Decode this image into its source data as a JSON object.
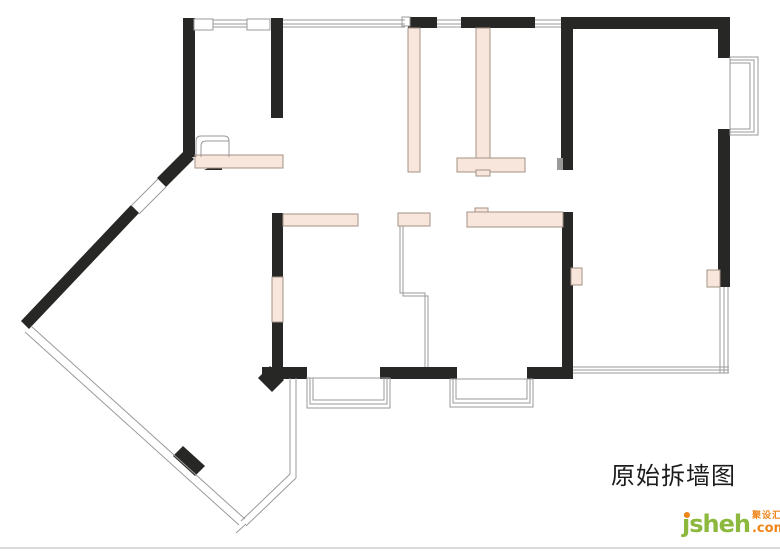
{
  "title": {
    "text": "原始拆墙图"
  },
  "logo": {
    "brand": "jsheh",
    "tagline": "聚设汇",
    "suffix": ".com"
  },
  "colors": {
    "wall": "#272725",
    "demo_fill": "#f8e6dc",
    "demo_stroke": "#a49286",
    "line": "#9a9a9a",
    "title_color": "#1c1c1c",
    "brand_green": "#8cb83d",
    "accent_orange": "#f08519",
    "divider": "#d9d9d9"
  },
  "plan": {
    "width": 780,
    "height": 551,
    "elements": [
      {
        "type": "wall",
        "name": "wall-left-top-vertical",
        "x": 183,
        "y": 18,
        "w": 12,
        "h": 139
      },
      {
        "type": "wall",
        "name": "wall-entry-vertical",
        "x": 271,
        "y": 18,
        "w": 12,
        "h": 100
      },
      {
        "type": "wall",
        "name": "wall-top-a",
        "x": 408,
        "y": 17,
        "w": 29,
        "h": 11
      },
      {
        "type": "wall",
        "name": "wall-top-b",
        "x": 461,
        "y": 17,
        "w": 74,
        "h": 11
      },
      {
        "type": "wall",
        "name": "wall-top-right",
        "x": 561,
        "y": 17,
        "w": 169,
        "h": 12
      },
      {
        "type": "wall",
        "name": "wall-livingroom-left-upper",
        "x": 561,
        "y": 17,
        "w": 12,
        "h": 153
      },
      {
        "type": "wall",
        "name": "wall-right-upper",
        "x": 718,
        "y": 17,
        "w": 12,
        "h": 41
      },
      {
        "type": "wall",
        "name": "wall-right-lower",
        "x": 718,
        "y": 129,
        "w": 12,
        "h": 158
      },
      {
        "type": "wall",
        "name": "wall-livingroom-left-lower",
        "x": 562,
        "y": 212,
        "w": 11,
        "h": 155
      },
      {
        "type": "wall",
        "name": "wall-interior-left-upper",
        "x": 272,
        "y": 213,
        "w": 11,
        "h": 64
      },
      {
        "type": "wall",
        "name": "wall-interior-left-lower",
        "x": 272,
        "y": 322,
        "w": 11,
        "h": 46
      },
      {
        "type": "wall",
        "name": "wall-bottom-left",
        "x": 262,
        "y": 367,
        "w": 45,
        "h": 12
      },
      {
        "type": "wall",
        "name": "wall-bottom-middle",
        "x": 380,
        "y": 367,
        "w": 77,
        "h": 12
      },
      {
        "type": "wall",
        "name": "wall-bottom-right",
        "x": 527,
        "y": 367,
        "w": 46,
        "h": 12
      },
      {
        "type": "wall",
        "name": "wall-diagonal-upper",
        "points": "185,150 194,159 166,187 157,178"
      },
      {
        "type": "wall",
        "name": "wall-diagonal-lower",
        "points": "131,205 139,213 29,329 21,321"
      },
      {
        "type": "wall",
        "name": "wall-diagonal-chunk",
        "points": "173,456 183,446 205,466 195,476"
      },
      {
        "type": "wall",
        "name": "wall-corner-stub",
        "points": "258,378 270,366 284,380 272,392"
      },
      {
        "type": "wall",
        "name": "door-threshold-triangle",
        "points": "204,170 222,162 222,170"
      },
      {
        "type": "demo",
        "name": "demolish-wall-entry",
        "x": 195,
        "y": 155,
        "w": 88,
        "h": 13
      },
      {
        "type": "demo",
        "name": "demolish-wall-kitchen-left",
        "x": 408,
        "y": 28,
        "w": 12,
        "h": 144
      },
      {
        "type": "demo",
        "name": "demolish-wall-kitchen-right",
        "x": 476,
        "y": 28,
        "w": 14,
        "h": 130
      },
      {
        "type": "demo",
        "name": "demolish-wall-kitchen-tbar",
        "x": 457,
        "y": 158,
        "w": 68,
        "h": 14
      },
      {
        "type": "demo",
        "name": "demolish-wall-kitchen-notch",
        "x": 476,
        "y": 170,
        "w": 14,
        "h": 6
      },
      {
        "type": "demo",
        "name": "demolish-wall-bedroom-a",
        "x": 283,
        "y": 214,
        "w": 75,
        "h": 12
      },
      {
        "type": "demo",
        "name": "demolish-wall-bedroom-b",
        "x": 398,
        "y": 213,
        "w": 32,
        "h": 13
      },
      {
        "type": "demo",
        "name": "demolish-wall-hall-bump",
        "x": 475,
        "y": 208,
        "w": 13,
        "h": 5
      },
      {
        "type": "demo",
        "name": "demolish-wall-hall",
        "x": 467,
        "y": 212,
        "w": 96,
        "h": 15
      },
      {
        "type": "demo",
        "name": "demolish-wall-interior-left",
        "x": 272,
        "y": 277,
        "w": 11,
        "h": 45
      },
      {
        "type": "demo",
        "name": "demolish-balcony-left",
        "x": 571,
        "y": 268,
        "w": 11,
        "h": 17
      },
      {
        "type": "demo",
        "name": "demolish-balcony-right",
        "x": 707,
        "y": 270,
        "w": 13,
        "h": 17
      },
      {
        "type": "winbox",
        "name": "window-box-a",
        "x": 194,
        "y": 19,
        "w": 19,
        "h": 11
      },
      {
        "type": "winbox",
        "name": "window-box-b",
        "x": 247,
        "y": 19,
        "w": 23,
        "h": 11
      },
      {
        "type": "winbox",
        "name": "window-box-c",
        "x": 402,
        "y": 17,
        "w": 8,
        "h": 9
      },
      {
        "type": "line",
        "name": "window-line",
        "x1": 213,
        "y1": 20,
        "x2": 247,
        "y2": 20
      },
      {
        "type": "line",
        "name": "window-line",
        "x1": 213,
        "y1": 24,
        "x2": 247,
        "y2": 24
      },
      {
        "type": "line",
        "name": "window-line",
        "x1": 213,
        "y1": 27,
        "x2": 247,
        "y2": 27
      },
      {
        "type": "line",
        "name": "window-line",
        "x1": 283,
        "y1": 20,
        "x2": 405,
        "y2": 20
      },
      {
        "type": "line",
        "name": "window-line",
        "x1": 283,
        "y1": 24,
        "x2": 405,
        "y2": 24
      },
      {
        "type": "line",
        "name": "window-line",
        "x1": 283,
        "y1": 27,
        "x2": 405,
        "y2": 27
      },
      {
        "type": "line",
        "name": "window-line",
        "x1": 437,
        "y1": 20,
        "x2": 461,
        "y2": 20
      },
      {
        "type": "line",
        "name": "window-line",
        "x1": 437,
        "y1": 24,
        "x2": 461,
        "y2": 24
      },
      {
        "type": "line",
        "name": "window-line",
        "x1": 437,
        "y1": 27,
        "x2": 461,
        "y2": 27
      },
      {
        "type": "line",
        "name": "window-line",
        "x1": 535,
        "y1": 20,
        "x2": 561,
        "y2": 20
      },
      {
        "type": "line",
        "name": "window-line",
        "x1": 535,
        "y1": 24,
        "x2": 561,
        "y2": 24
      },
      {
        "type": "line",
        "name": "window-line",
        "x1": 535,
        "y1": 27,
        "x2": 561,
        "y2": 27
      },
      {
        "type": "frame",
        "name": "bay-window-right",
        "x": 730,
        "y": 57,
        "w": 28,
        "h": 78
      },
      {
        "type": "frame",
        "name": "bay-window-right",
        "x": 730,
        "y": 60,
        "w": 24,
        "h": 72
      },
      {
        "type": "frame",
        "name": "bay-window-right",
        "x": 730,
        "y": 63,
        "w": 20,
        "h": 66
      },
      {
        "type": "frame",
        "name": "bay-window-bottom-left",
        "x": 307,
        "y": 378,
        "w": 83,
        "h": 30
      },
      {
        "type": "frame",
        "name": "bay-window-bottom-left",
        "x": 310,
        "y": 378,
        "w": 77,
        "h": 26
      },
      {
        "type": "frame",
        "name": "bay-window-bottom-left",
        "x": 313,
        "y": 378,
        "w": 71,
        "h": 22
      },
      {
        "type": "frame",
        "name": "bay-window-bottom-middle",
        "x": 450,
        "y": 379,
        "w": 83,
        "h": 28
      },
      {
        "type": "frame",
        "name": "bay-window-bottom-middle",
        "x": 453,
        "y": 379,
        "w": 77,
        "h": 24
      },
      {
        "type": "frame",
        "name": "bay-window-bottom-middle",
        "x": 456,
        "y": 379,
        "w": 71,
        "h": 20
      },
      {
        "type": "line",
        "name": "balcony-glazing-bottom",
        "x1": 573,
        "y1": 367,
        "x2": 729,
        "y2": 367
      },
      {
        "type": "line",
        "name": "balcony-glazing-bottom",
        "x1": 573,
        "y1": 370,
        "x2": 729,
        "y2": 370
      },
      {
        "type": "line",
        "name": "balcony-glazing-bottom",
        "x1": 573,
        "y1": 373,
        "x2": 729,
        "y2": 373
      },
      {
        "type": "line",
        "name": "balcony-glazing-right",
        "x1": 720,
        "y1": 287,
        "x2": 720,
        "y2": 373
      },
      {
        "type": "line",
        "name": "balcony-glazing-right",
        "x1": 724,
        "y1": 287,
        "x2": 724,
        "y2": 373
      },
      {
        "type": "line",
        "name": "balcony-glazing-right",
        "x1": 728,
        "y1": 287,
        "x2": 728,
        "y2": 373
      },
      {
        "type": "line",
        "name": "diagonal-window-upper",
        "x1": 158,
        "y1": 179,
        "x2": 131,
        "y2": 206
      },
      {
        "type": "line",
        "name": "diagonal-window-upper",
        "x1": 166,
        "y1": 187,
        "x2": 139,
        "y2": 214
      },
      {
        "type": "line",
        "name": "diagonal-window-long",
        "x1": 25,
        "y1": 332,
        "x2": 239,
        "y2": 525
      },
      {
        "type": "line",
        "name": "diagonal-window-long",
        "x1": 31,
        "y1": 326,
        "x2": 245,
        "y2": 519
      },
      {
        "type": "line",
        "name": "diagonal-window-corner",
        "x1": 241,
        "y1": 521,
        "x2": 290,
        "y2": 474
      },
      {
        "type": "line",
        "name": "diagonal-window-corner",
        "x1": 246,
        "y1": 526,
        "x2": 296,
        "y2": 478
      },
      {
        "type": "line",
        "name": "diagonal-window-cap",
        "x1": 236,
        "y1": 533,
        "x2": 246,
        "y2": 524
      },
      {
        "type": "line",
        "name": "window-wall-vertical",
        "x1": 290,
        "y1": 378,
        "x2": 290,
        "y2": 474
      },
      {
        "type": "line",
        "name": "window-wall-vertical",
        "x1": 296,
        "y1": 378,
        "x2": 296,
        "y2": 478
      },
      {
        "type": "path",
        "name": "partition-line",
        "d": "M400,226 L400,293 L425,293 L425,367"
      },
      {
        "type": "path",
        "name": "partition-line",
        "d": "M403,226 L403,296 L428,296 L428,367"
      },
      {
        "type": "path",
        "name": "door-frame",
        "d": "M196,157 L196,141 Q196,136 201,136 L224,136 Q229,136 229,141 L229,157"
      },
      {
        "type": "path",
        "name": "door-arc",
        "d": "M201,157 L201,146 Q201,141 206,141 L229,141"
      },
      {
        "type": "gray",
        "name": "wall-stub-gray",
        "x": 557,
        "y": 158,
        "w": 6,
        "h": 12
      }
    ]
  }
}
